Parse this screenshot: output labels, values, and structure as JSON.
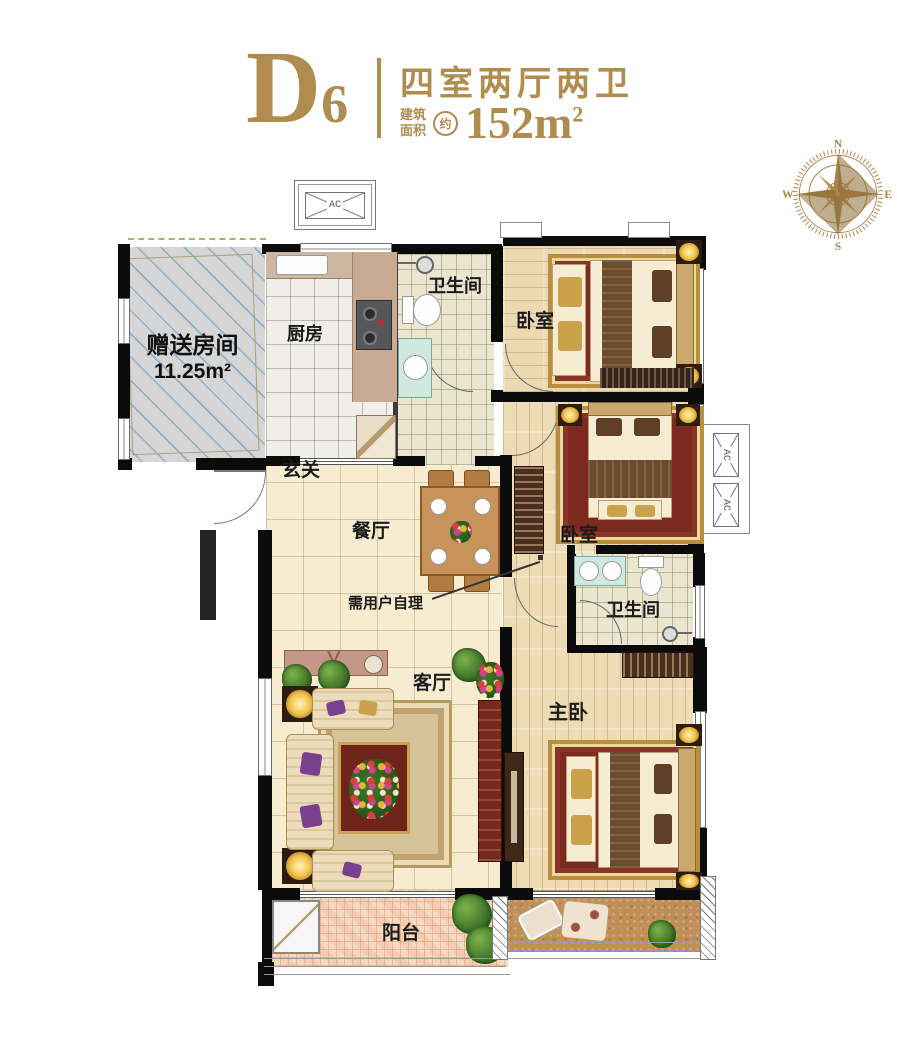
{
  "header": {
    "unit_letter": "D",
    "unit_number": "6",
    "title": "四室两厅两卫",
    "area_label_line1": "建筑",
    "area_label_line2": "面积",
    "approx": "约",
    "area_value": "152m",
    "area_sup": "2"
  },
  "compass": {
    "n": "N",
    "e": "E",
    "s": "S",
    "w": "W"
  },
  "plan": {
    "rooms": {
      "gift_room_name": "赠送房间",
      "gift_room_area": "11.25m²",
      "kitchen": "厨房",
      "bath1": "卫生间",
      "bedroom1": "卧室",
      "hallway": "玄关",
      "dining": "餐厅",
      "self_note": "需用户自理",
      "living": "客厅",
      "bedroom2": "卧室",
      "bath2": "卫生间",
      "master": "主卧",
      "balcony": "阳台"
    },
    "markers": {
      "ac": "AC"
    }
  },
  "colors": {
    "accent_gold": "#b08c4e",
    "wall_black": "#0b0b0b",
    "gift_hatch_blue": "#8fb0c6",
    "wood_floor": "#ecd9b2",
    "hall_tile": "#f7ecd0",
    "balcony_mosaic": "#f5d9c2",
    "rug_red": "#7c2a20"
  }
}
